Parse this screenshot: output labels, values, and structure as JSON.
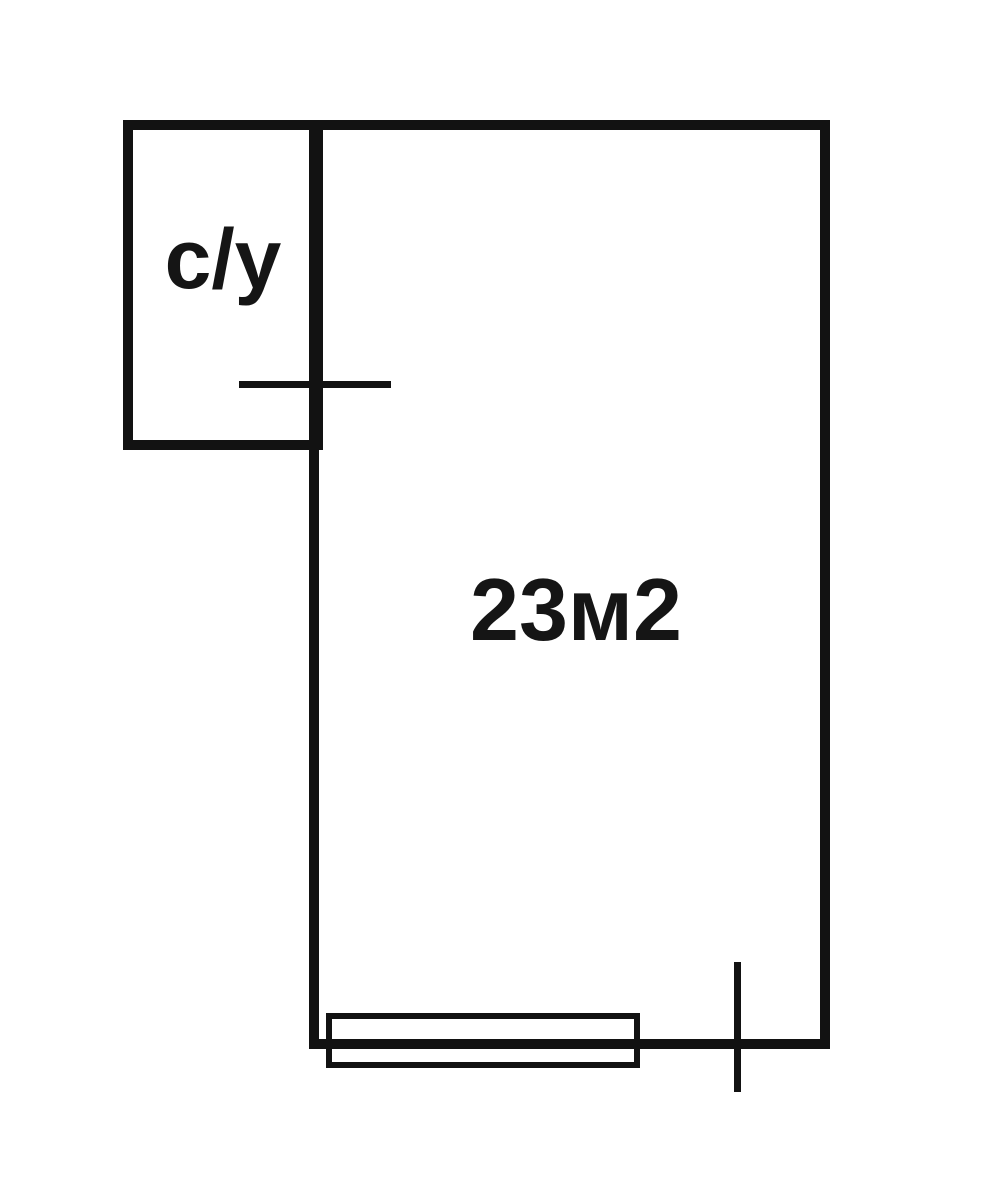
{
  "floorplan": {
    "bathroom": {
      "label": "с/у"
    },
    "main_room": {
      "area_label": "23м2"
    }
  },
  "colors": {
    "wall": "#121212",
    "background": "#ffffff",
    "text": "#151515"
  }
}
